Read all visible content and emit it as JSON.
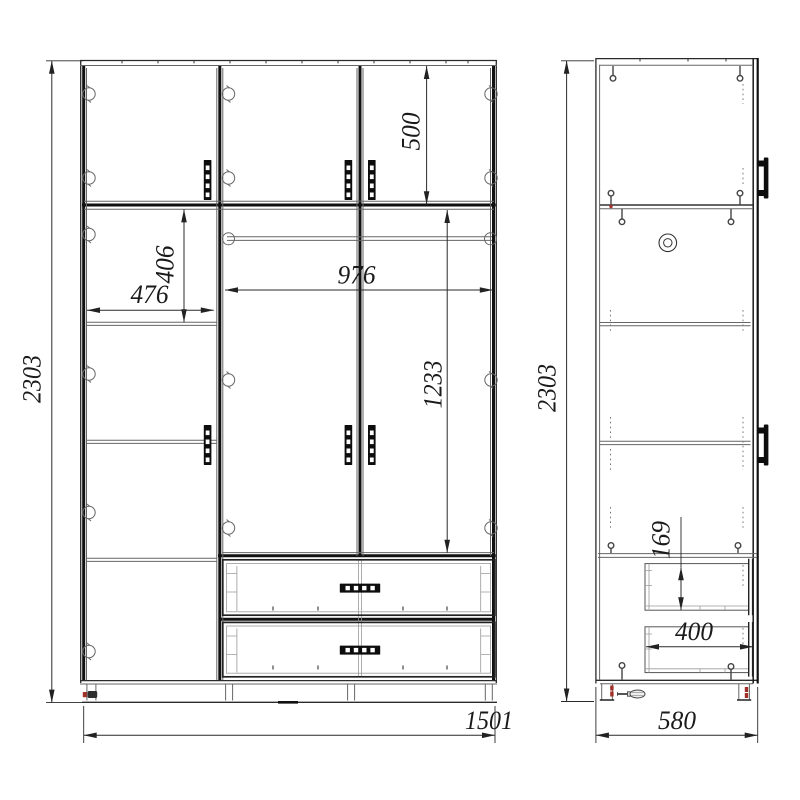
{
  "drawing": {
    "type": "wardrobe assembly technical drawing",
    "views": {
      "front": "front view",
      "side": "side view"
    },
    "colors": {
      "line": "#111111",
      "thin_line": "#666666",
      "dim_line": "#2a2a2a",
      "accent_red": "#a03028"
    },
    "icons": {
      "hinge": "circle-cam-mark",
      "screw": "screw-with-head-mark",
      "screwdriver": "screwdriver-glyph",
      "door_handle": "vertical-bar-handle",
      "drawer_handle": "horizontal-bar-handle"
    }
  },
  "dims": {
    "front_height": "2303",
    "front_width": "1501",
    "top_section_height": "500",
    "left_inner_width": "476",
    "left_top_shelf_height": "406",
    "hanging_section_width": "976",
    "hanging_section_height": "1233",
    "side_height": "2303",
    "side_depth": "580",
    "drawer_side_height": "169",
    "drawer_inner_depth": "400"
  }
}
